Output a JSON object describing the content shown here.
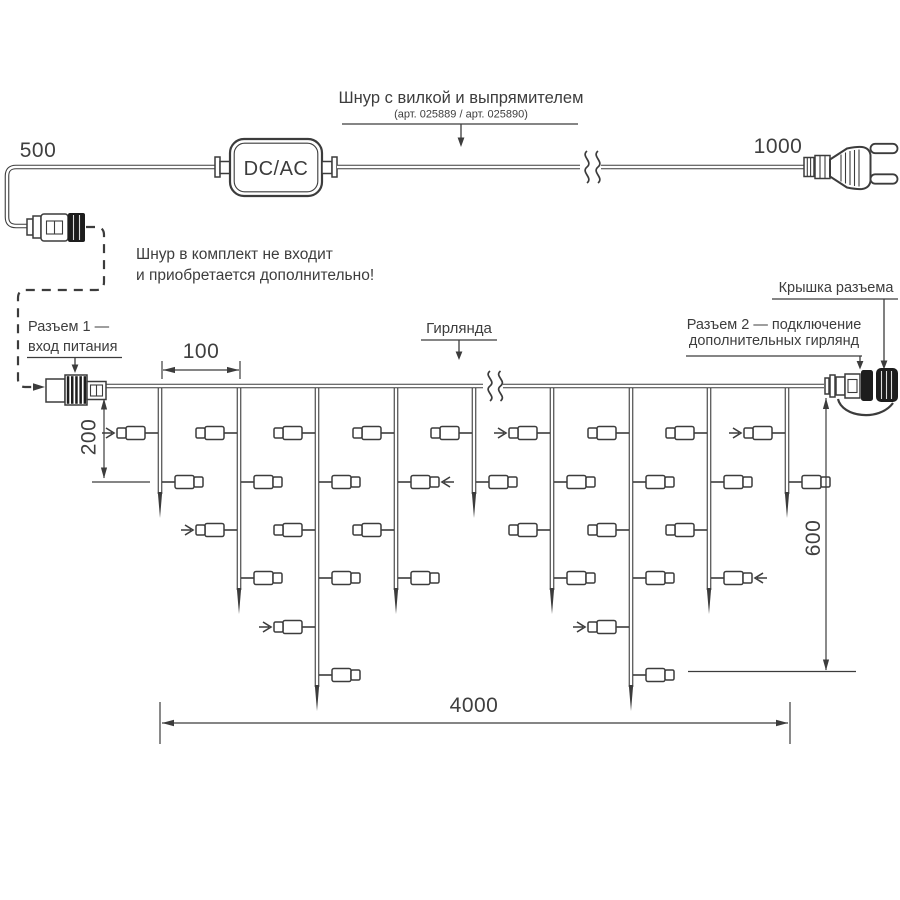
{
  "colors": {
    "line": "#3c3c3c",
    "dark_fill": "#1d1d1d",
    "text": "#3d3d3d",
    "background": "#ffffff"
  },
  "power_cord": {
    "dim_left": "500",
    "dim_right": "1000",
    "adapter_label": "DC/AC",
    "callout_title": "Шнур с вилкой и выпрямителем",
    "callout_subtitle": "(арт. 025889 / арт. 025890)",
    "note_line1": "Шнур в комплект не входит",
    "note_line2": "и приобретается дополнительно!"
  },
  "garland": {
    "connector1_line1": "Разъем 1 —",
    "connector1_line2": "вход питания",
    "garland_label": "Гирлянда",
    "cap_label": "Крышка разъема",
    "connector2_line1": "Разъем 2 — подключение",
    "connector2_line2": "дополнительных гирлянд",
    "dim_spacing": "100",
    "dim_drop_min": "200",
    "dim_drop_max": "600",
    "dim_total": "4000"
  },
  "diagram_data": {
    "wire_y": 386,
    "wire_x1": 106,
    "wire_x2": 824,
    "break_x": 494,
    "drop_xs": [
      160,
      239,
      317,
      396,
      474,
      552,
      631,
      709,
      787
    ],
    "lamp_counts": [
      2,
      4,
      6,
      4,
      2,
      4,
      6,
      4,
      2
    ],
    "row_ys": [
      433,
      482,
      530,
      578,
      627,
      675
    ],
    "row_sides": [
      "left",
      "right",
      "left",
      "right",
      "left",
      "right"
    ],
    "arrow_marks": [
      [
        0,
        0
      ],
      [
        1,
        2
      ],
      [
        2,
        4
      ],
      [
        3,
        1
      ],
      [
        5,
        0
      ],
      [
        6,
        4
      ],
      [
        7,
        3
      ],
      [
        8,
        0
      ]
    ]
  }
}
